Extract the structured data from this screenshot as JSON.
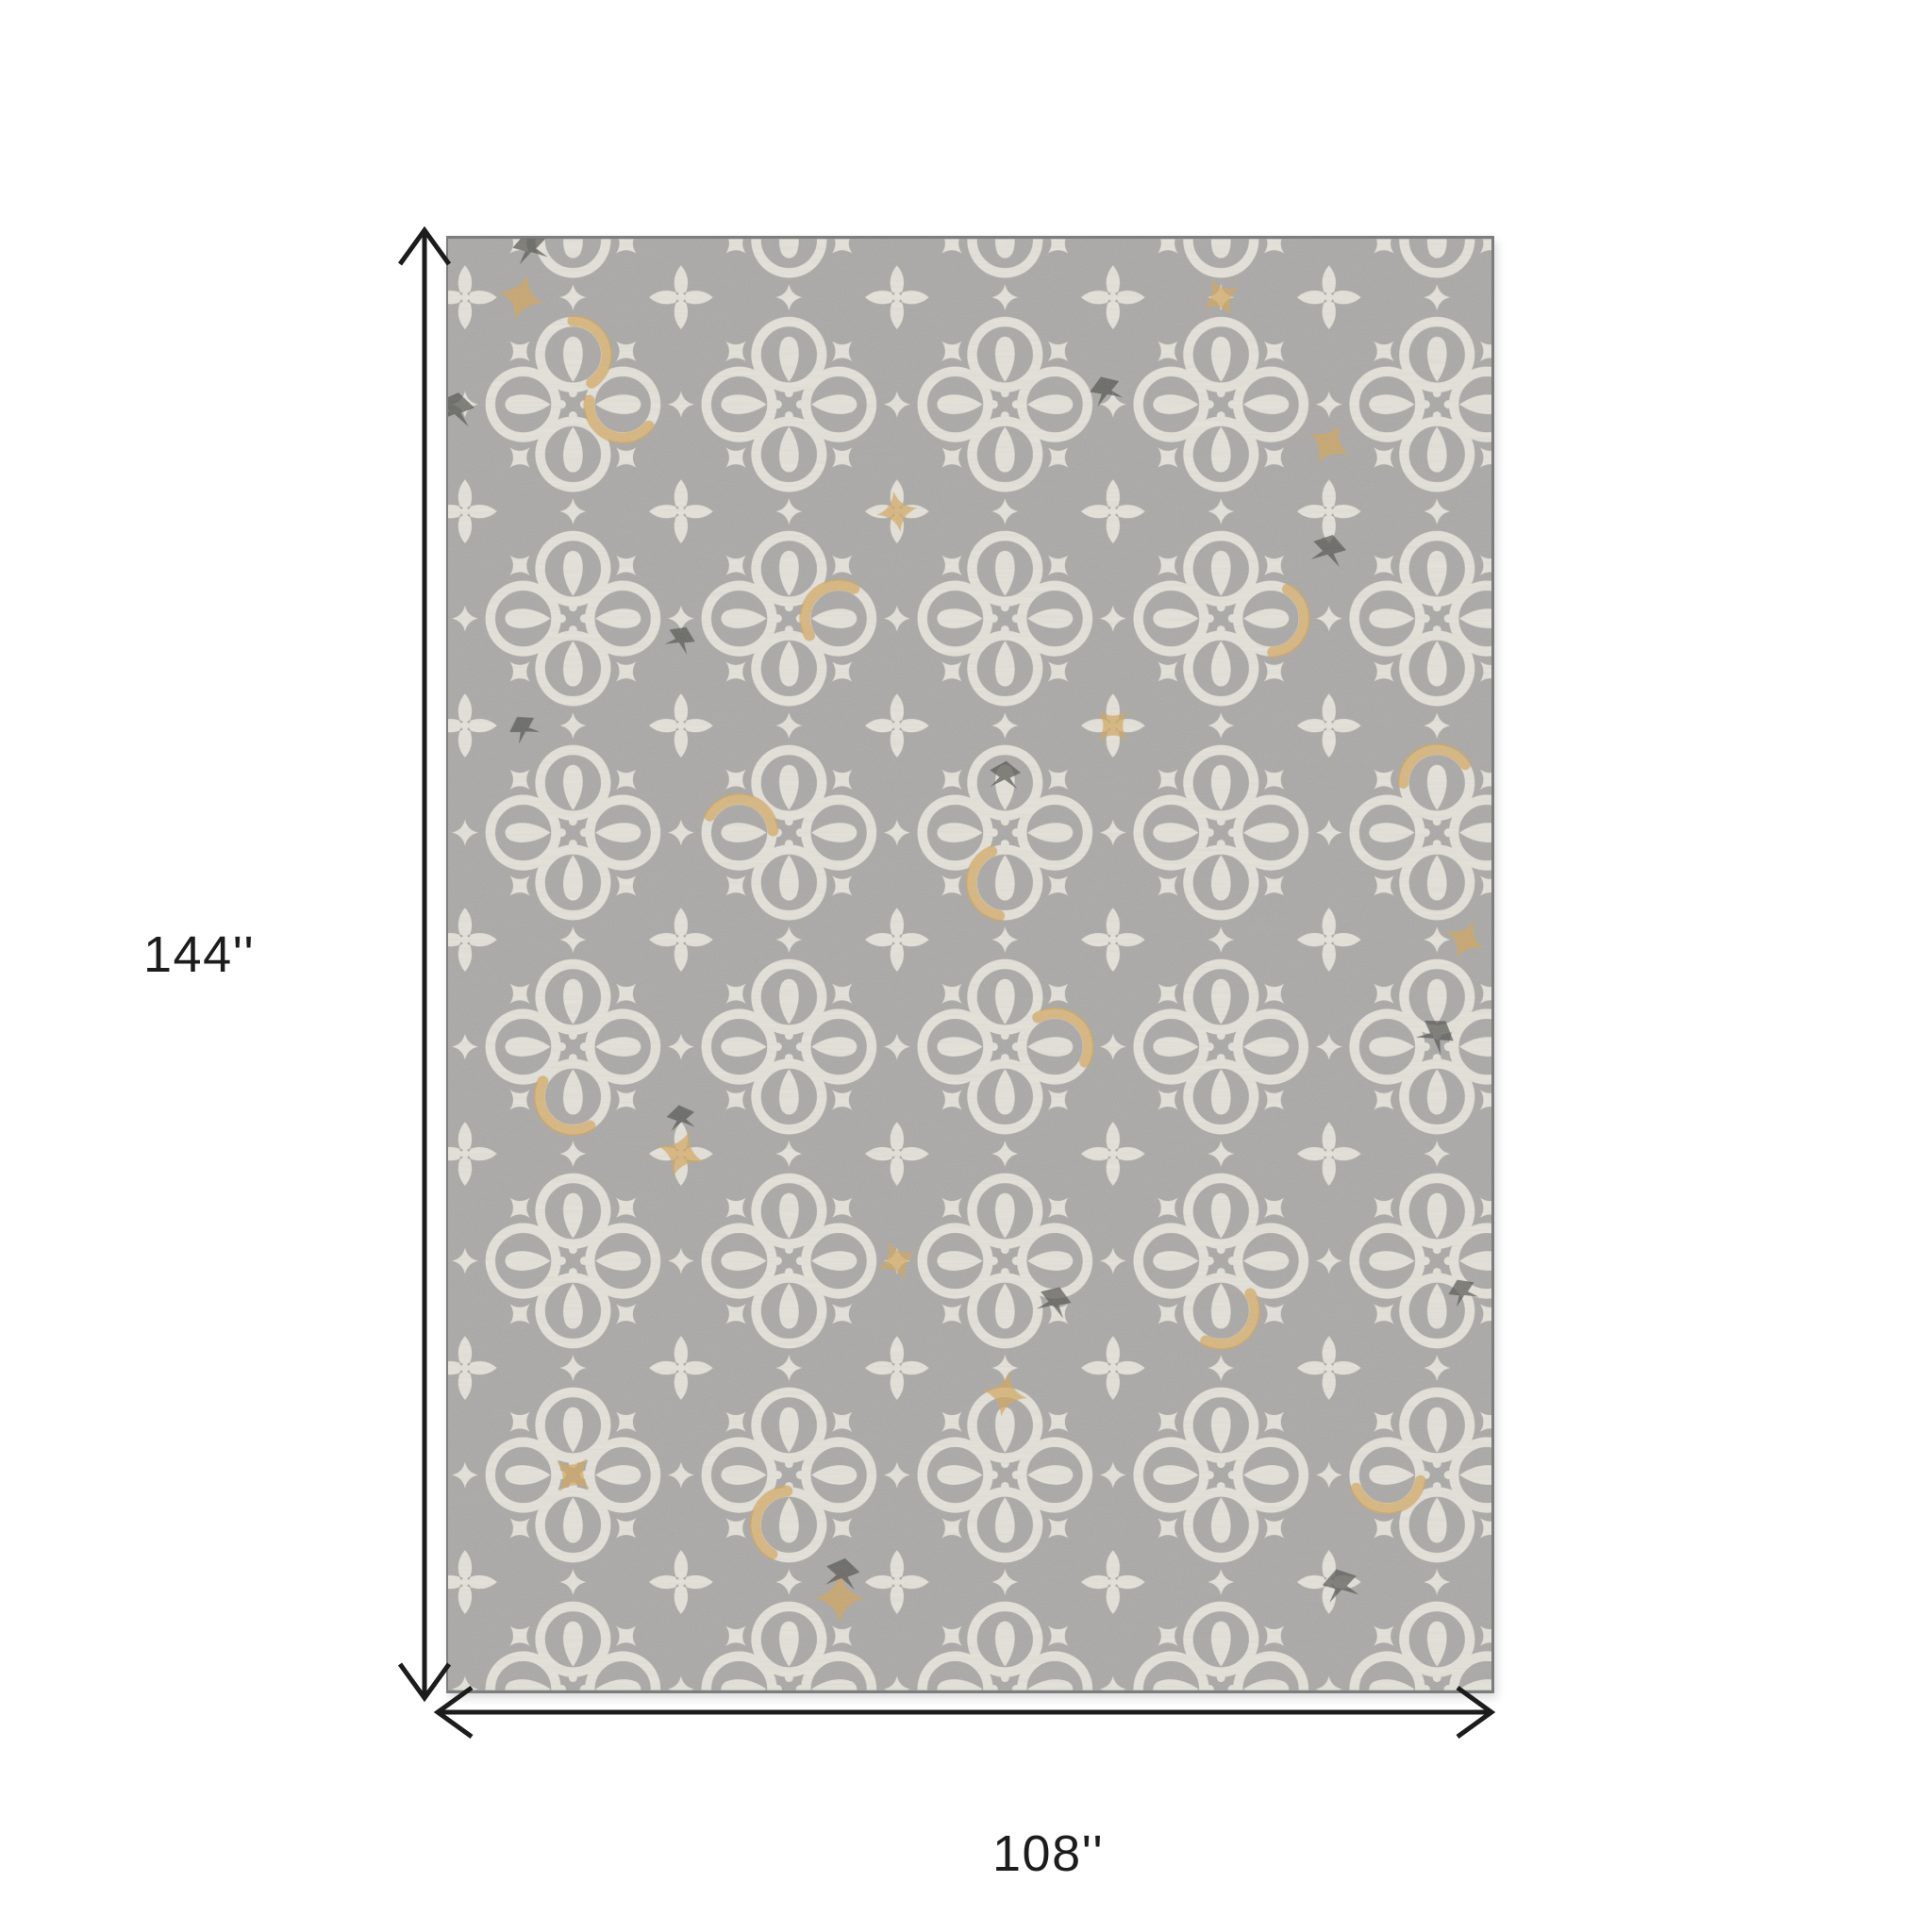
{
  "diagram": {
    "height_label": "144''",
    "width_label": "108''"
  },
  "colors": {
    "background": "#ffffff",
    "arrow": "#1c1c1c",
    "label": "#1c1c1c",
    "rug_base": "#a7a6a4",
    "rug_cream": "#eae7de",
    "rug_gold": "#d3a355",
    "rug_dark": "#4b4a47",
    "rug_edge": "#7d7d7d"
  }
}
